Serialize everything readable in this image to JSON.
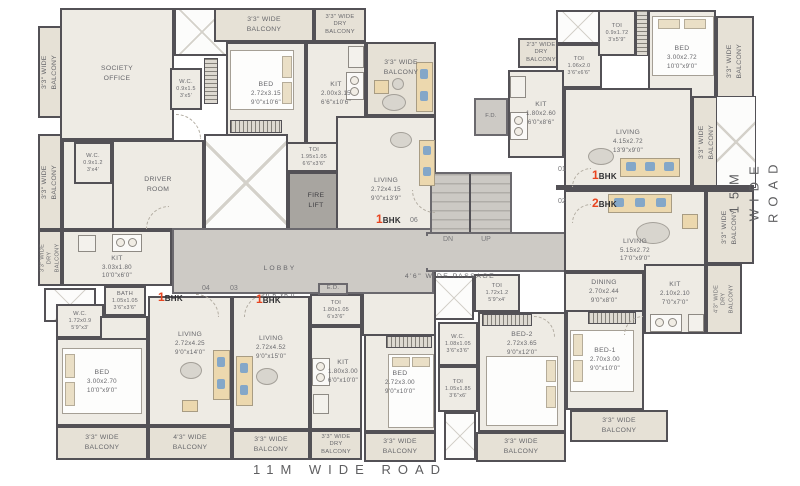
{
  "colors": {
    "accent_red": "#e8441f",
    "wall": "#535156",
    "floor": "#eeebe4",
    "balcony": "#e6e1d6",
    "circulation": "#cdcac5"
  },
  "roads": {
    "bottom": "11M WIDE ROAD",
    "right": "15M WIDE ROAD"
  },
  "units": {
    "u01": {
      "no": "01",
      "num": "1",
      "bhk": "BHK"
    },
    "u02": {
      "no": "02",
      "num": "2",
      "bhk": "BHK"
    },
    "u03": {
      "no": "03",
      "num": "1",
      "bhk": "BHK"
    },
    "u04": {
      "no": "04",
      "num": "1",
      "bhk": "BHK"
    },
    "u06": {
      "no": "06",
      "num": "1",
      "bhk": "BHK"
    }
  },
  "rooms": {
    "society": {
      "n": "SOCIETY\nOFFICE"
    },
    "wc_society": {
      "n": "W.C.",
      "m": "0.9x1.5",
      "f": "3'x5'"
    },
    "bed_top": {
      "n": "BED",
      "m": "2.72x3.15",
      "f": "9'0\"x10'6\""
    },
    "kit_top": {
      "n": "KIT",
      "m": "2.00x3.15",
      "f": "6'6\"x10'6\""
    },
    "toi_top": {
      "n": "TOI",
      "m": "1.95x1.05",
      "f": "6'6\"x3'6\""
    },
    "living06": {
      "n": "LIVING",
      "m": "2.72x4.15",
      "f": "9'0\"x13'9\""
    },
    "firelift": {
      "n": "FIRE\nLIFT"
    },
    "lobby": {
      "n": "LOBBY",
      "f": "20'6\"x6'0\""
    },
    "passage": {
      "n": "4'6\" WIDE PASSAGE"
    },
    "stairs": {
      "dn": "DN",
      "up": "UP"
    },
    "fd": {
      "n": "F.D."
    },
    "ed": {
      "n": "E.D."
    },
    "wc_driver": {
      "n": "W.C.",
      "m": "0.9x1.2",
      "f": "3'x4'"
    },
    "driver": {
      "n": "DRIVER\nROOM"
    },
    "kit_left": {
      "n": "KIT",
      "m": "3.03x1.80",
      "f": "10'0\"x6'0\""
    },
    "bath_left": {
      "n": "BATH",
      "m": "1.05x1.05",
      "f": "3'6\"x3'6\""
    },
    "wc_left": {
      "n": "W.C.",
      "m": "1.72x0.9",
      "f": "5'9\"x3'"
    },
    "bed04": {
      "n": "BED",
      "m": "3.00x2.70",
      "f": "10'0\"x9'0\""
    },
    "living04": {
      "n": "LIVING",
      "m": "2.72x4.25",
      "f": "9'0\"x14'0\""
    },
    "living03": {
      "n": "LIVING",
      "m": "2.72x4.52",
      "f": "9'0\"x15'0\""
    },
    "toi03": {
      "n": "TOI",
      "m": "1.80x1.05",
      "f": "6'x3'6\""
    },
    "kit03": {
      "n": "KIT",
      "m": "1.80x3.00",
      "f": "6'0\"x10'0\""
    },
    "bed06": {
      "n": "BED",
      "m": "2.72x3.00",
      "f": "9'0\"x10'0\""
    },
    "toi06": {
      "n": "TOI",
      "m": "1.72x1.2",
      "f": "5'9\"x4'"
    },
    "kit01": {
      "n": "KIT",
      "m": "1.80x2.60",
      "f": "6'0\"x8'6\""
    },
    "toi01a": {
      "n": "TOI",
      "m": "1.06x2.0",
      "f": "3'6\"x6'6\""
    },
    "toi01b": {
      "n": "TOI",
      "m": "0.9x1.72",
      "f": "3'x5'9\""
    },
    "bed01": {
      "n": "BED",
      "m": "3.00x2.72",
      "f": "10'0\"x9'0\""
    },
    "living01": {
      "n": "LIVING",
      "m": "4.15x2.72",
      "f": "13'9\"x9'0\""
    },
    "living02": {
      "n": "LIVING",
      "m": "5.15x2.72",
      "f": "17'0\"x9'0\""
    },
    "dining02": {
      "n": "DINING",
      "m": "2.70x2.44",
      "f": "9'0\"x8'0\""
    },
    "kit02": {
      "n": "KIT",
      "m": "2.10x2.10",
      "f": "7'0\"x7'0\""
    },
    "wc02": {
      "n": "W.C.",
      "m": "1.08x1.05",
      "f": "3'6\"x3'6\""
    },
    "toi02": {
      "n": "TOI",
      "m": "1.05x1.85",
      "f": "3'6\"x6'"
    },
    "bed2": {
      "n": "BED-2",
      "m": "2.72x3.65",
      "f": "9'0\"x12'0\""
    },
    "bed1": {
      "n": "BED-1",
      "m": "2.70x3.00",
      "f": "9'0\"x10'0\""
    }
  },
  "balconies": {
    "w33": "3'3\" WIDE\nBALCONY",
    "w33dry": "3'3\" WIDE\nDRY\nBALCONY",
    "w43": "4'3\" WIDE\nBALCONY",
    "w43dry": "4'3\" WIDE\nDRY\nBALCONY",
    "w23dry": "2'3\" WIDE\nDRY\nBALCONY"
  }
}
